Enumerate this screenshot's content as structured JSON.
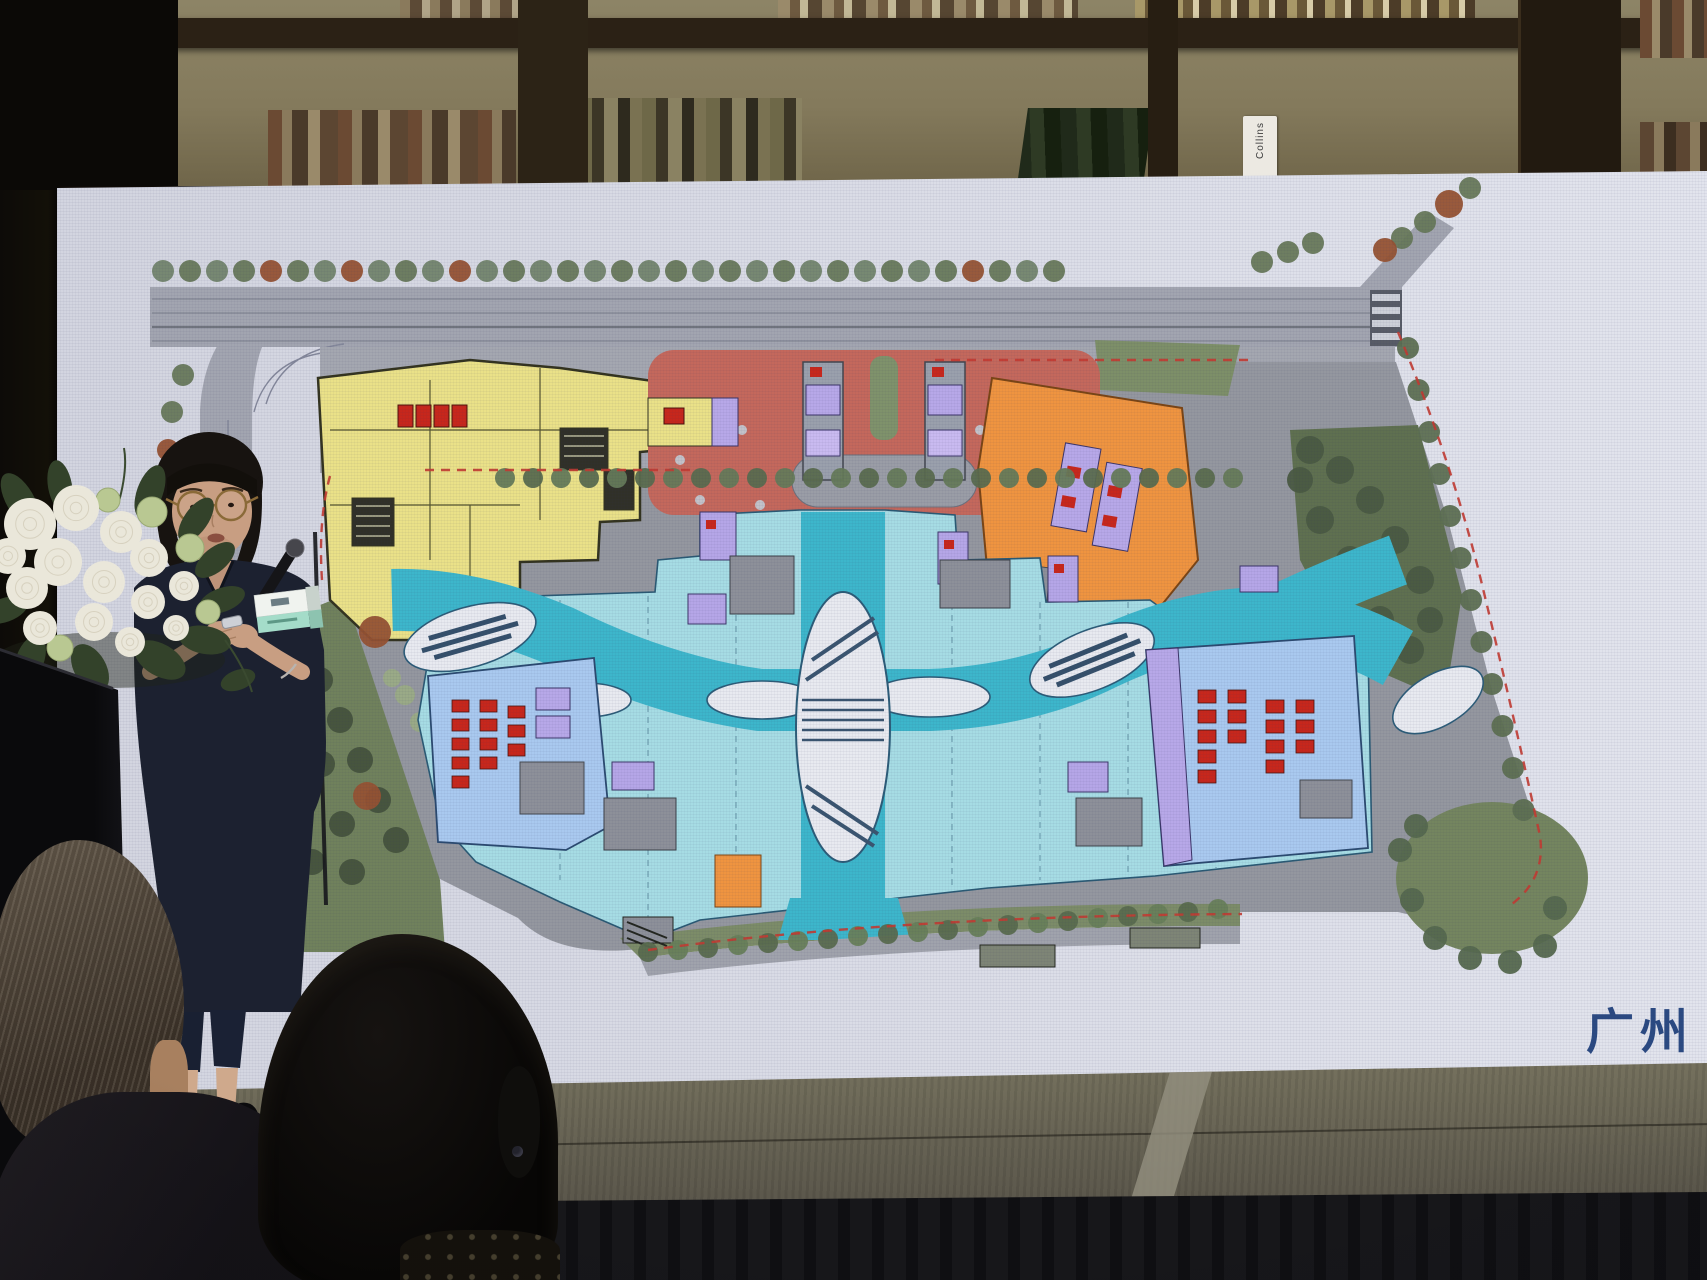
{
  "screen": {
    "caption": "广州",
    "caption_color": "#2b4a82",
    "surface_color": "#d9dbe5"
  },
  "bookshelf": {
    "book_spine_label": "Collins"
  },
  "site_plan": {
    "type": "architectural-master-plan",
    "colors": {
      "road_gray": "#a2a5b0",
      "plaza_gray": "#94979f",
      "retail_cyan": "#a6dce4",
      "walkway_teal": "#3db6cb",
      "yellow_block": "#eae188",
      "orange_block": "#ef9440",
      "dropoff_red": "#c4685c",
      "blue_block": "#a9c9ef",
      "core_purple": "#b5a6e7",
      "seat_red": "#c7271c",
      "landscape_green": "#74855f",
      "boundary_dash_red": "#c23b32"
    }
  }
}
